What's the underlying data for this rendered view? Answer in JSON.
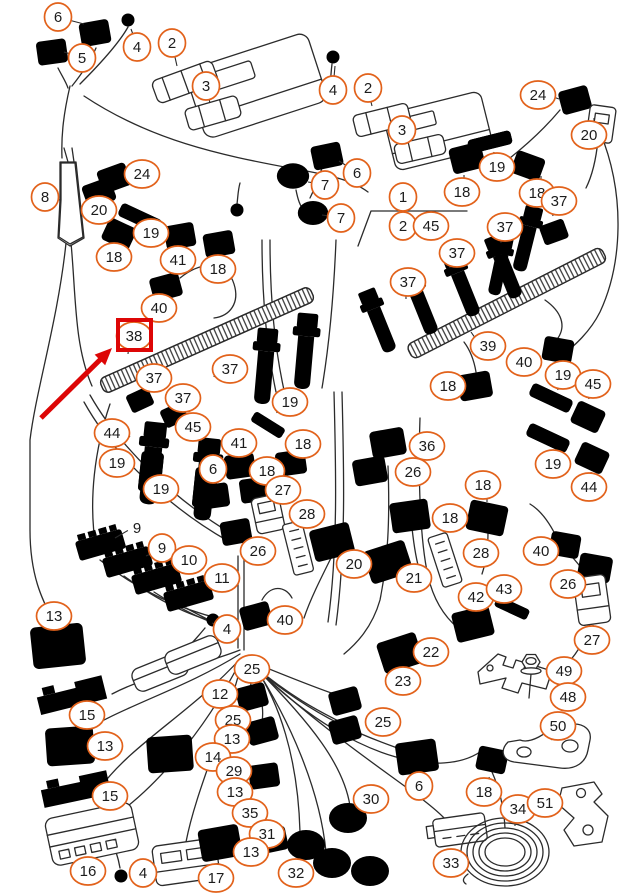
{
  "diagram": {
    "type": "wiring-harness-parts-diagram",
    "background": "#ffffff",
    "colors": {
      "line": "#2b2b2b",
      "callout_ring": "#e2621b",
      "number_text": "#1c1c1c",
      "highlight_red": "#dd0606"
    },
    "highlight": {
      "item": "38",
      "box": {
        "x": 118,
        "y": 320,
        "w": 33,
        "h": 30
      },
      "arrow": {
        "x1": 41,
        "y1": 418,
        "x2": 112,
        "y2": 348
      }
    },
    "callouts": [
      {
        "n": "6",
        "x": 58,
        "y": 17,
        "lx": 84,
        "ly": 24
      },
      {
        "n": "5",
        "x": 82,
        "y": 58,
        "lx": 64,
        "ly": 52
      },
      {
        "n": "4",
        "x": 137,
        "y": 47,
        "lx": 131,
        "ly": 29
      },
      {
        "n": "2",
        "x": 172,
        "y": 43,
        "lx": 177,
        "ly": 66
      },
      {
        "n": "3",
        "x": 206,
        "y": 86,
        "lx": 210,
        "ly": 103
      },
      {
        "n": "4",
        "x": 333,
        "y": 90,
        "lx": 335,
        "ly": 66
      },
      {
        "n": "2",
        "x": 368,
        "y": 88,
        "lx": 372,
        "ly": 106
      },
      {
        "n": "3",
        "x": 402,
        "y": 130,
        "lx": 406,
        "ly": 144
      },
      {
        "n": "6",
        "x": 357,
        "y": 173,
        "lx": 339,
        "ly": 161
      },
      {
        "n": "7",
        "x": 325,
        "y": 185,
        "lx": 308,
        "ly": 182
      },
      {
        "n": "7",
        "x": 341,
        "y": 218,
        "lx": 322,
        "ly": 215
      },
      {
        "n": "24",
        "x": 538,
        "y": 95,
        "lx": 559,
        "ly": 99
      },
      {
        "n": "20",
        "x": 589,
        "y": 135,
        "lx": 594,
        "ly": 118
      },
      {
        "n": "19",
        "x": 497,
        "y": 167,
        "lx": 494,
        "ly": 152
      },
      {
        "n": "18",
        "x": 462,
        "y": 192,
        "lx": 464,
        "ly": 175
      },
      {
        "n": "18",
        "x": 537,
        "y": 193,
        "lx": 541,
        "ly": 176
      },
      {
        "n": "37",
        "x": 559,
        "y": 201,
        "lx": 553,
        "ly": 216
      },
      {
        "n": "37",
        "x": 505,
        "y": 227,
        "lx": 501,
        "ly": 243
      },
      {
        "n": "1",
        "x": 403,
        "y": 197,
        "lx": 403,
        "ly": 211
      },
      {
        "n": "2",
        "x": 403,
        "y": 226,
        "lx": 416,
        "ly": 226
      },
      {
        "n": "45",
        "x": 431,
        "y": 226,
        "lx": 415,
        "ly": 226
      },
      {
        "n": "8",
        "x": 45,
        "y": 197,
        "lx": 60,
        "ly": 200
      },
      {
        "n": "24",
        "x": 142,
        "y": 174,
        "lx": 125,
        "ly": 178
      },
      {
        "n": "20",
        "x": 99,
        "y": 210,
        "lx": 102,
        "ly": 198
      },
      {
        "n": "19",
        "x": 151,
        "y": 233,
        "lx": 142,
        "ly": 222
      },
      {
        "n": "18",
        "x": 114,
        "y": 257,
        "lx": 116,
        "ly": 243
      },
      {
        "n": "41",
        "x": 178,
        "y": 260,
        "lx": 180,
        "ly": 246
      },
      {
        "n": "18",
        "x": 218,
        "y": 269,
        "lx": 220,
        "ly": 255
      },
      {
        "n": "40",
        "x": 159,
        "y": 308,
        "lx": 170,
        "ly": 297
      },
      {
        "n": "38",
        "x": 134,
        "y": 336,
        "lx": 128,
        "ly": 354,
        "boxed": true
      },
      {
        "n": "37",
        "x": 408,
        "y": 282,
        "lx": 406,
        "ly": 299
      },
      {
        "n": "37",
        "x": 457,
        "y": 253,
        "lx": 450,
        "ly": 268
      },
      {
        "n": "39",
        "x": 488,
        "y": 346,
        "lx": 471,
        "ly": 332
      },
      {
        "n": "37",
        "x": 154,
        "y": 378,
        "lx": 146,
        "ly": 391
      },
      {
        "n": "37",
        "x": 183,
        "y": 398,
        "lx": 171,
        "ly": 408
      },
      {
        "n": "37",
        "x": 230,
        "y": 369,
        "lx": 214,
        "ly": 377
      },
      {
        "n": "44",
        "x": 112,
        "y": 433,
        "lx": 130,
        "ly": 437
      },
      {
        "n": "45",
        "x": 193,
        "y": 427,
        "lx": 201,
        "ly": 441
      },
      {
        "n": "19",
        "x": 117,
        "y": 463,
        "lx": 134,
        "ly": 466
      },
      {
        "n": "19",
        "x": 161,
        "y": 489,
        "lx": 178,
        "ly": 491
      },
      {
        "n": "19",
        "x": 290,
        "y": 402,
        "lx": 277,
        "ly": 413
      },
      {
        "n": "41",
        "x": 239,
        "y": 443,
        "lx": 240,
        "ly": 457
      },
      {
        "n": "6",
        "x": 213,
        "y": 469,
        "lx": 214,
        "ly": 484
      },
      {
        "n": "18",
        "x": 267,
        "y": 471,
        "lx": 256,
        "ly": 481
      },
      {
        "n": "18",
        "x": 303,
        "y": 444,
        "lx": 292,
        "ly": 455
      },
      {
        "n": "27",
        "x": 283,
        "y": 490,
        "lx": 273,
        "ly": 501
      },
      {
        "n": "28",
        "x": 307,
        "y": 514,
        "lx": 303,
        "ly": 528
      },
      {
        "n": "26",
        "x": 258,
        "y": 551,
        "lx": 246,
        "ly": 542
      },
      {
        "n": "40",
        "x": 524,
        "y": 362,
        "lx": 540,
        "ly": 357
      },
      {
        "n": "18",
        "x": 448,
        "y": 386,
        "lx": 461,
        "ly": 388
      },
      {
        "n": "19",
        "x": 563,
        "y": 375,
        "lx": 558,
        "ly": 390
      },
      {
        "n": "45",
        "x": 593,
        "y": 384,
        "lx": 589,
        "ly": 399
      },
      {
        "n": "19",
        "x": 553,
        "y": 464,
        "lx": 551,
        "ly": 450
      },
      {
        "n": "44",
        "x": 589,
        "y": 487,
        "lx": 591,
        "ly": 472
      },
      {
        "n": "36",
        "x": 427,
        "y": 446,
        "lx": 409,
        "ly": 447
      },
      {
        "n": "26",
        "x": 413,
        "y": 472,
        "lx": 397,
        "ly": 474
      },
      {
        "n": "18",
        "x": 483,
        "y": 485,
        "lx": 487,
        "ly": 502
      },
      {
        "n": "18",
        "x": 450,
        "y": 518,
        "lx": 433,
        "ly": 517
      },
      {
        "n": "28",
        "x": 481,
        "y": 553,
        "lx": 465,
        "ly": 557
      },
      {
        "n": "40",
        "x": 541,
        "y": 551,
        "lx": 555,
        "ly": 548
      },
      {
        "n": "26",
        "x": 568,
        "y": 584,
        "lx": 582,
        "ly": 586
      },
      {
        "n": "27",
        "x": 592,
        "y": 640,
        "lx": 593,
        "ly": 625
      },
      {
        "n": "42",
        "x": 476,
        "y": 597,
        "lx": 472,
        "ly": 611
      },
      {
        "n": "43",
        "x": 504,
        "y": 589,
        "lx": 500,
        "ly": 603
      },
      {
        "n": "20",
        "x": 354,
        "y": 564,
        "lx": 343,
        "ly": 554
      },
      {
        "n": "21",
        "x": 414,
        "y": 578,
        "lx": 401,
        "ly": 567
      },
      {
        "n": "9",
        "x": 137,
        "y": 528,
        "plain": true,
        "lx": 115,
        "ly": 538
      },
      {
        "n": "9",
        "x": 162,
        "y": 548,
        "lx": 146,
        "ly": 556
      },
      {
        "n": "10",
        "x": 189,
        "y": 560,
        "lx": 173,
        "ly": 567
      },
      {
        "n": "11",
        "x": 222,
        "y": 578,
        "lx": 205,
        "ly": 582
      },
      {
        "n": "13",
        "x": 54,
        "y": 616,
        "lx": 56,
        "ly": 630
      },
      {
        "n": "4",
        "x": 227,
        "y": 629,
        "lx": 212,
        "ly": 623
      },
      {
        "n": "40",
        "x": 285,
        "y": 620,
        "lx": 270,
        "ly": 621
      },
      {
        "n": "12",
        "x": 220,
        "y": 694,
        "lx": 206,
        "ly": 687
      },
      {
        "n": "25",
        "x": 252,
        "y": 669,
        "lx": 251,
        "ly": 684
      },
      {
        "n": "25",
        "x": 233,
        "y": 720,
        "lx": 247,
        "ly": 723
      },
      {
        "n": "13",
        "x": 232,
        "y": 739,
        "lx": 247,
        "ly": 740
      },
      {
        "n": "14",
        "x": 213,
        "y": 757,
        "lx": 198,
        "ly": 758
      },
      {
        "n": "29",
        "x": 234,
        "y": 771,
        "lx": 249,
        "ly": 773
      },
      {
        "n": "13",
        "x": 235,
        "y": 792,
        "lx": 250,
        "ly": 793
      },
      {
        "n": "35",
        "x": 250,
        "y": 813,
        "lx": 262,
        "ly": 820
      },
      {
        "n": "31",
        "x": 267,
        "y": 834,
        "lx": 283,
        "ly": 838
      },
      {
        "n": "13",
        "x": 251,
        "y": 852,
        "lx": 237,
        "ly": 850
      },
      {
        "n": "32",
        "x": 296,
        "y": 873,
        "lx": 312,
        "ly": 872
      },
      {
        "n": "15",
        "x": 87,
        "y": 715,
        "lx": 78,
        "ly": 703
      },
      {
        "n": "13",
        "x": 105,
        "y": 746,
        "lx": 91,
        "ly": 747
      },
      {
        "n": "15",
        "x": 110,
        "y": 796,
        "lx": 96,
        "ly": 797
      },
      {
        "n": "16",
        "x": 88,
        "y": 871,
        "lx": 90,
        "ly": 857
      },
      {
        "n": "4",
        "x": 143,
        "y": 873,
        "lx": 131,
        "ly": 874
      },
      {
        "n": "17",
        "x": 216,
        "y": 878,
        "lx": 202,
        "ly": 876
      },
      {
        "n": "25",
        "x": 383,
        "y": 722,
        "lx": 367,
        "ly": 722
      },
      {
        "n": "22",
        "x": 431,
        "y": 652,
        "lx": 417,
        "ly": 656
      },
      {
        "n": "23",
        "x": 403,
        "y": 681,
        "lx": 404,
        "ly": 667
      },
      {
        "n": "6",
        "x": 419,
        "y": 786,
        "lx": 420,
        "ly": 771
      },
      {
        "n": "30",
        "x": 371,
        "y": 799,
        "lx": 359,
        "ly": 808
      },
      {
        "n": "33",
        "x": 451,
        "y": 863,
        "lx": 455,
        "ly": 849
      },
      {
        "n": "49",
        "x": 564,
        "y": 671,
        "lx": 548,
        "ly": 670
      },
      {
        "n": "48",
        "x": 568,
        "y": 697,
        "lx": 552,
        "ly": 697
      },
      {
        "n": "50",
        "x": 558,
        "y": 726,
        "lx": 552,
        "ly": 740
      },
      {
        "n": "18",
        "x": 484,
        "y": 792,
        "lx": 489,
        "ly": 777
      },
      {
        "n": "34",
        "x": 518,
        "y": 809,
        "lx": 515,
        "ly": 826
      },
      {
        "n": "51",
        "x": 545,
        "y": 803,
        "lx": 560,
        "ly": 802
      }
    ]
  }
}
